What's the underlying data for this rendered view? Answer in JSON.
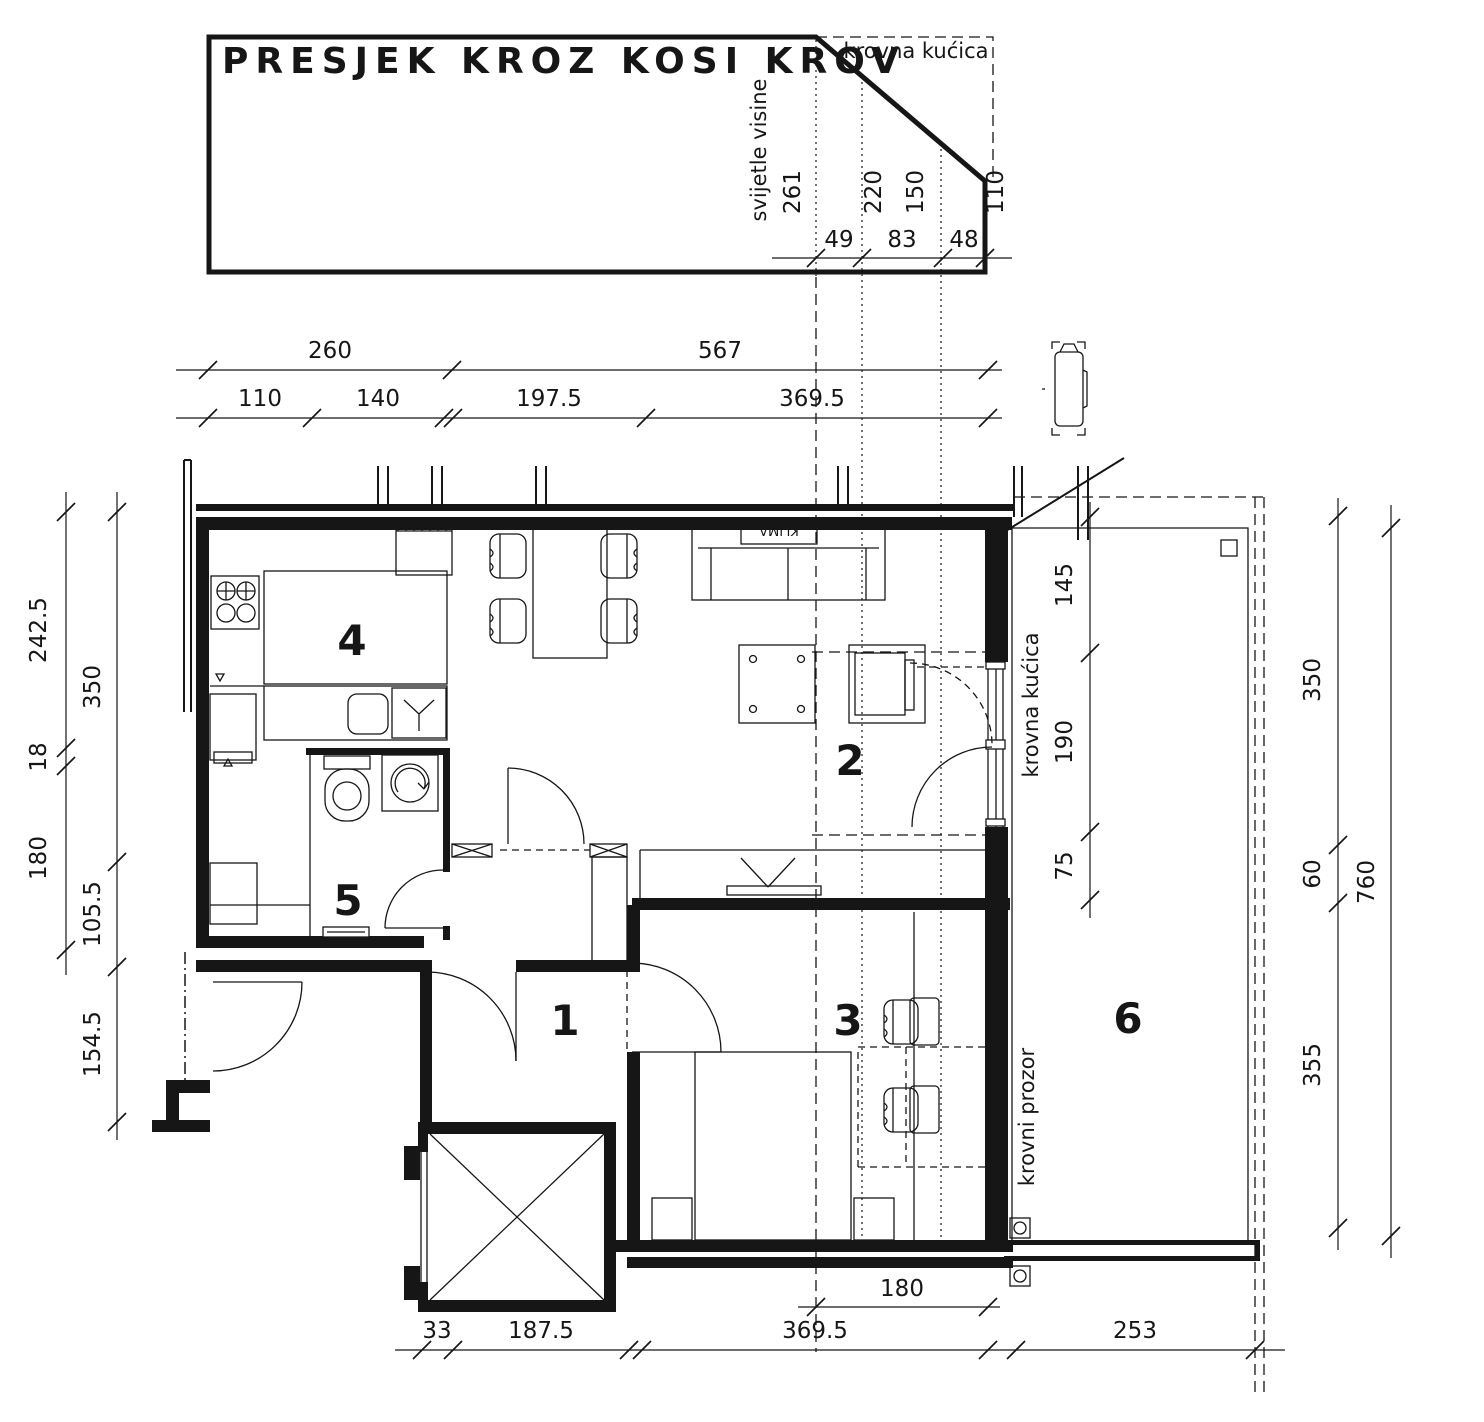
{
  "ink": "#161616",
  "title": "PRESJEK KROZ KOSI KROV",
  "section": {
    "label_krovna_kucica": "krovna kućica",
    "label_svijetle_visine": "svijetle visine",
    "h1": "261",
    "h2": "220",
    "h3": "150",
    "h4": "110",
    "w1": "49",
    "w2": "83",
    "w3": "48"
  },
  "dims_top": {
    "a": "260",
    "b": "567",
    "c": "110",
    "d": "140",
    "e": "197.5",
    "f": "369.5"
  },
  "dims_left": {
    "a": "242.5",
    "b": "18",
    "c": "180",
    "d": "350",
    "e": "105.5",
    "f": "154.5"
  },
  "dims_right": {
    "a": "350",
    "b": "60",
    "c": "355",
    "d": "760"
  },
  "dims_terrace": {
    "a": "145",
    "b": "190",
    "c": "75"
  },
  "dims_bottom": {
    "a": "33",
    "b": "187.5",
    "c": "369.5",
    "d": "253",
    "e": "180"
  },
  "rooms": {
    "hall": "1",
    "living": "2",
    "bedroom": "3",
    "kitchen": "4",
    "bath": "5",
    "terrace": "6"
  },
  "labels": {
    "klima": "KLIMA",
    "krovna_kucica_plan": "krovna kućica",
    "krovni_prozor": "krovni prozor"
  }
}
